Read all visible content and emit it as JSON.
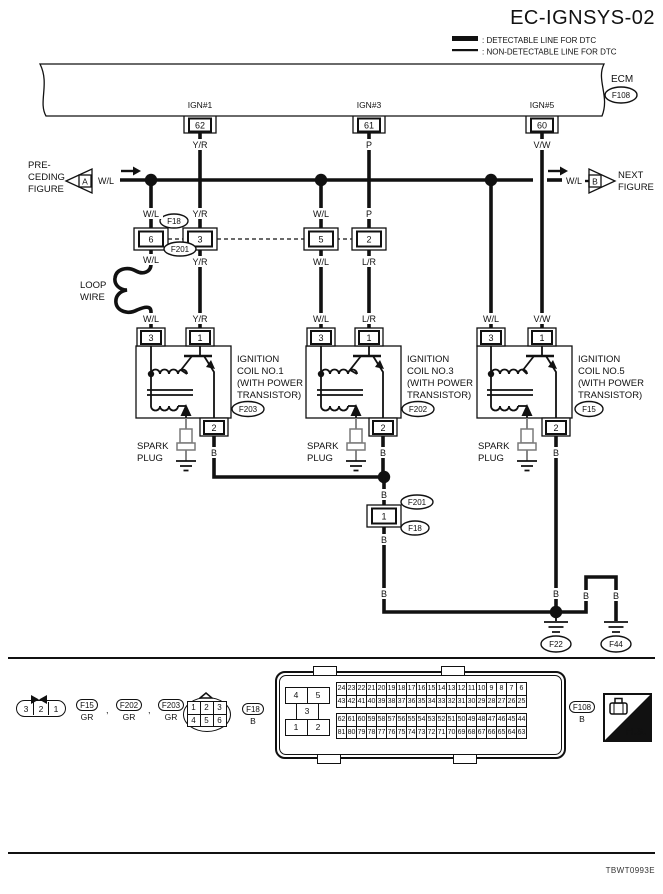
{
  "title": "EC-IGNSYS-02",
  "legend": {
    "detectable": ": DETECTABLE LINE FOR DTC",
    "non_detectable": ": NON-DETECTABLE LINE FOR DTC"
  },
  "ecm": {
    "label": "ECM",
    "tag": "F108",
    "pins": [
      {
        "name": "IGN#1",
        "number": "62",
        "wire": "Y/R"
      },
      {
        "name": "IGN#3",
        "number": "61",
        "wire": "P"
      },
      {
        "name": "IGN#5",
        "number": "60",
        "wire": "V/W"
      }
    ]
  },
  "refs": {
    "preceding": {
      "l1": "PRE-",
      "l2": "CEDING",
      "l3": "FIGURE",
      "tag": "A"
    },
    "next": {
      "l1": "NEXT",
      "l2": "FIGURE",
      "tag": "B"
    }
  },
  "wires": {
    "wl": "W/L",
    "yr": "Y/R",
    "p": "P",
    "lr": "L/R",
    "vw": "V/W",
    "b": "B"
  },
  "loop": {
    "l1": "LOOP",
    "l2": "WIRE"
  },
  "inline": {
    "tag_top": "F18",
    "tag_bottom": "F201",
    "pin_a": "6",
    "pin_b": "3",
    "pin_c": "5",
    "pin_d": "2"
  },
  "mid": {
    "pin": "1",
    "tag_top": "F201",
    "tag_bottom": "F18"
  },
  "coils": [
    {
      "p_left": "3",
      "p_right": "1",
      "p_bot": "2",
      "n1": "IGNITION",
      "n2": "COIL NO.1",
      "n3": "(WITH POWER",
      "n4": "TRANSISTOR)",
      "tag": "F203",
      "sp1": "SPARK",
      "sp2": "PLUG"
    },
    {
      "p_left": "3",
      "p_right": "1",
      "p_bot": "2",
      "n1": "IGNITION",
      "n2": "COIL NO.3",
      "n3": "(WITH POWER",
      "n4": "TRANSISTOR)",
      "tag": "F202",
      "sp1": "SPARK",
      "sp2": "PLUG"
    },
    {
      "p_left": "3",
      "p_right": "1",
      "p_bot": "2",
      "n1": "IGNITION",
      "n2": "COIL NO.5",
      "n3": "(WITH POWER",
      "n4": "TRANSISTOR)",
      "tag": "F15",
      "sp1": "SPARK",
      "sp2": "PLUG"
    }
  ],
  "grounds": {
    "left": "F22",
    "right": "F44"
  },
  "bottom": {
    "conn3": {
      "cells": [
        "3",
        "2",
        "1"
      ]
    },
    "conn3_tags": [
      {
        "id": "F15",
        "color": "GR"
      },
      {
        "id": "F202",
        "color": "GR"
      },
      {
        "id": "F203",
        "color": "GR"
      }
    ],
    "separator": ",",
    "conn6": {
      "cells": [
        "1",
        "2",
        "3",
        "4",
        "5",
        "6"
      ],
      "tag": "F18",
      "color": "B"
    },
    "ecm_conn": {
      "left": [
        "4",
        "5",
        "3",
        "1",
        "2"
      ],
      "rows": [
        [
          "24",
          "23",
          "22",
          "21",
          "20",
          "19",
          "18",
          "17",
          "16",
          "15",
          "14",
          "13",
          "12",
          "11",
          "10",
          "9",
          "8",
          "7",
          "6"
        ],
        [
          "43",
          "42",
          "41",
          "40",
          "39",
          "38",
          "37",
          "36",
          "35",
          "34",
          "33",
          "32",
          "31",
          "30",
          "29",
          "28",
          "27",
          "26",
          "25"
        ],
        [
          "62",
          "61",
          "60",
          "59",
          "58",
          "57",
          "56",
          "55",
          "54",
          "53",
          "52",
          "51",
          "50",
          "49",
          "48",
          "47",
          "46",
          "45",
          "44"
        ],
        [
          "81",
          "80",
          "79",
          "78",
          "77",
          "76",
          "75",
          "74",
          "73",
          "72",
          "71",
          "70",
          "69",
          "68",
          "67",
          "66",
          "65",
          "64",
          "63"
        ]
      ],
      "tag": "F108",
      "color": "B"
    },
    "hs": "H.S."
  },
  "footer_code": "TBWT0993E",
  "colors": {
    "line": "#111111",
    "plug_gray": "#7a7a7a",
    "paper": "#ffffff"
  }
}
